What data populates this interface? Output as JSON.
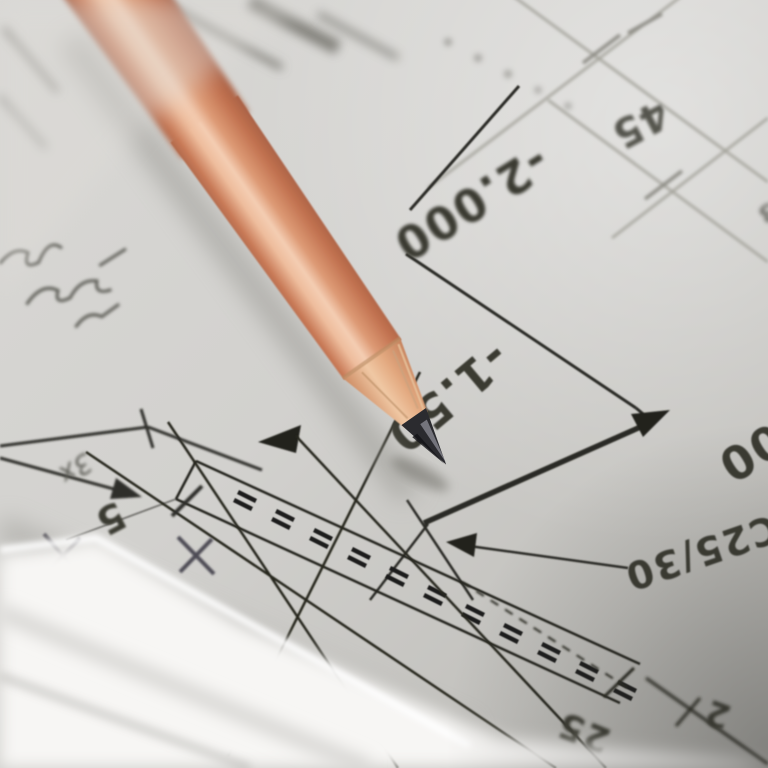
{
  "drawing_labels": {
    "dim_2000": "-2.000",
    "dim_45": "45",
    "level_150": "-1.50",
    "level_000": "000",
    "concrete_grade": "C25/30",
    "dim_25": "25",
    "dim_5": "5",
    "note_3x": "3x",
    "dim_2": "2",
    "dim_3": "3"
  },
  "colors": {
    "ink": "#34342d",
    "ink_soft": "#4b4b43",
    "line_light": "#a3a29a",
    "pencil_wood": "#d08a66",
    "pencil_highlight": "#f6d2b8",
    "graphite": "#2b2b2f",
    "paper": "#d3d2cf",
    "paper_shadow": "#9c9b96",
    "white_sheet": "#f7f6f4",
    "handwriting": "#5c5b55"
  }
}
